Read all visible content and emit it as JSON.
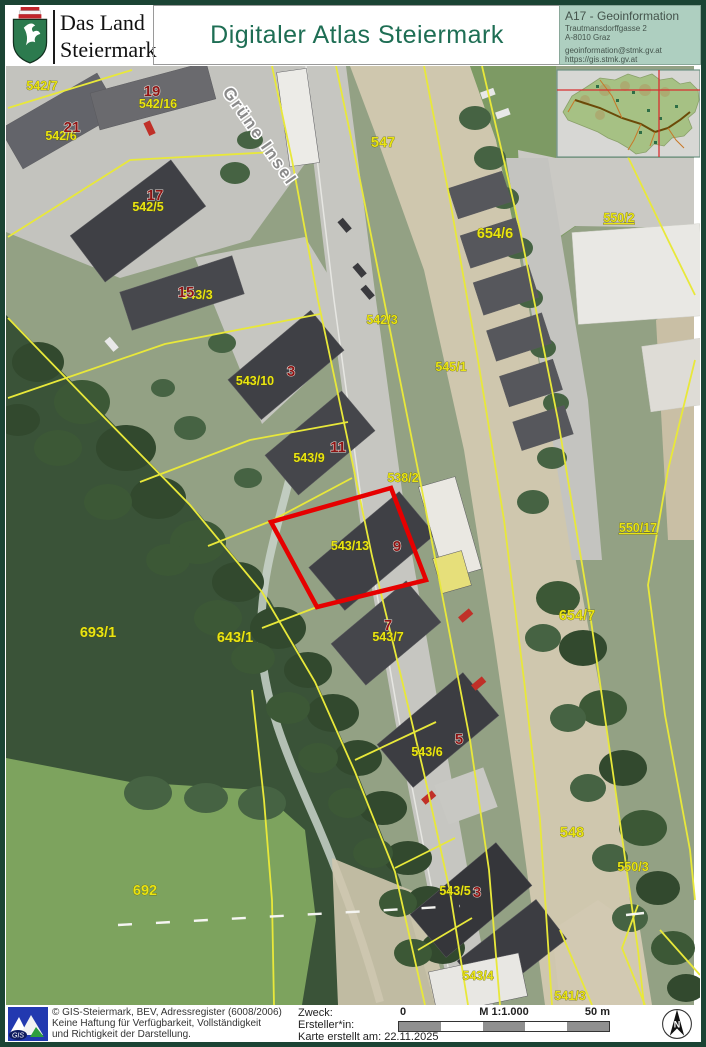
{
  "header": {
    "logo": {
      "line1": "Das Land",
      "line2": "Steiermark"
    },
    "title": "Digitaler Atlas Steiermark",
    "info": {
      "department": "A17 - Geoinformation",
      "street": "Trautmansdorffgasse 2",
      "city": "A-8010 Graz",
      "email": "geoinformation@stmk.gv.at",
      "url": "https://gis.stmk.gv.at"
    }
  },
  "map": {
    "street_label": "Grüne Insel",
    "parcels": [
      {
        "text": "542/7"
      },
      {
        "text": "542/16"
      },
      {
        "text": "542/6"
      },
      {
        "text": "542/5"
      },
      {
        "text": "543/3"
      },
      {
        "text": "547"
      },
      {
        "text": "654/6"
      },
      {
        "text": "550/2"
      },
      {
        "text": "542/3"
      },
      {
        "text": "545/1"
      },
      {
        "text": "543/10"
      },
      {
        "text": "543/9"
      },
      {
        "text": "538/2"
      },
      {
        "text": "543/13"
      },
      {
        "text": "550/17"
      },
      {
        "text": "654/7"
      },
      {
        "text": "693/1"
      },
      {
        "text": "643/1"
      },
      {
        "text": "543/7"
      },
      {
        "text": "543/6"
      },
      {
        "text": "548"
      },
      {
        "text": "550/3"
      },
      {
        "text": "692"
      },
      {
        "text": "543/5"
      },
      {
        "text": "543/4"
      },
      {
        "text": "541/3"
      }
    ],
    "houses": [
      {
        "text": "19"
      },
      {
        "text": "21"
      },
      {
        "text": "17"
      },
      {
        "text": "15"
      },
      {
        "text": "3"
      },
      {
        "text": "11"
      },
      {
        "text": "9"
      },
      {
        "text": "7"
      },
      {
        "text": "5"
      },
      {
        "text": "3"
      }
    ],
    "colors": {
      "parcel_line": "#e8e83a",
      "highlight": "#e60000"
    }
  },
  "footer": {
    "copyright_line1": "© GIS-Steiermark, BEV, Adressregister (6008/2006)",
    "copyright_line2": "Keine Haftung für Verfügbarkeit, Vollständigkeit",
    "copyright_line3": "und Richtigkeit der Darstellung.",
    "zweck_label": "Zweck:",
    "ersteller_label": "Ersteller*in:",
    "created_label": "Karte erstellt am: 22.11.2025",
    "scale": {
      "zero": "0",
      "ratio": "M 1:1.000",
      "max": "50 m"
    },
    "north_label": "N",
    "gis_logo_label": "GIS"
  }
}
